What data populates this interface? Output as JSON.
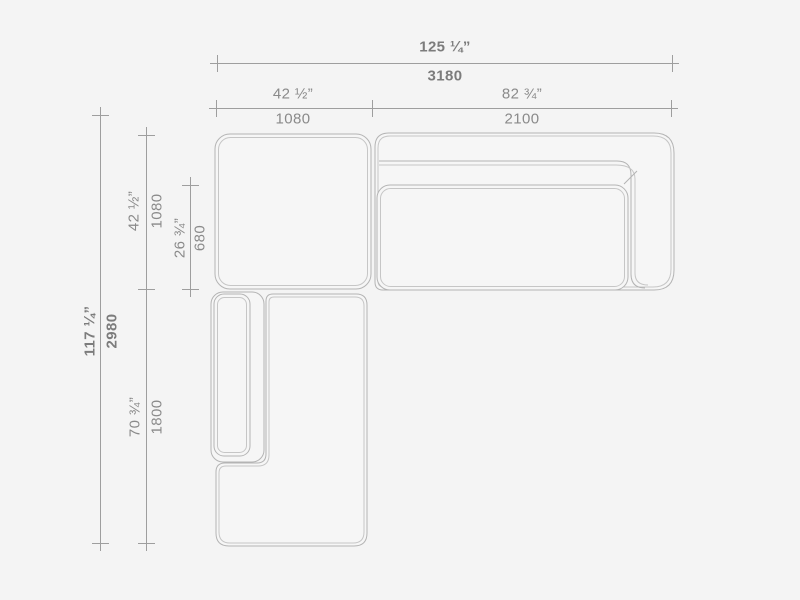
{
  "drawing": {
    "type": "sectional-sofa-plan-view",
    "units": [
      "inches",
      "millimeters"
    ],
    "dimensions": {
      "overall_width": {
        "inches": "125 ¼”",
        "mm": "3180"
      },
      "left_module_width": {
        "inches": "42 ½”",
        "mm": "1080"
      },
      "right_module_width": {
        "inches": "82 ¾”",
        "mm": "2100"
      },
      "overall_depth": {
        "inches": "117 ¼”",
        "mm": "2980"
      },
      "top_module_depth": {
        "inches": "42 ½”",
        "mm": "1080"
      },
      "seat_depth": {
        "inches": "26 ¾”",
        "mm": "680"
      },
      "chaise_length": {
        "inches": "70 ¾”",
        "mm": "1800"
      }
    },
    "colors": {
      "background": "#f4f4f4",
      "furniture_line": "#b4b4b4",
      "furniture_inner_line": "#c6c6c6",
      "dimension_line": "#9e9e9e",
      "label_text": "#8a8a8a",
      "label_text_bold": "#7c7c7c"
    }
  }
}
